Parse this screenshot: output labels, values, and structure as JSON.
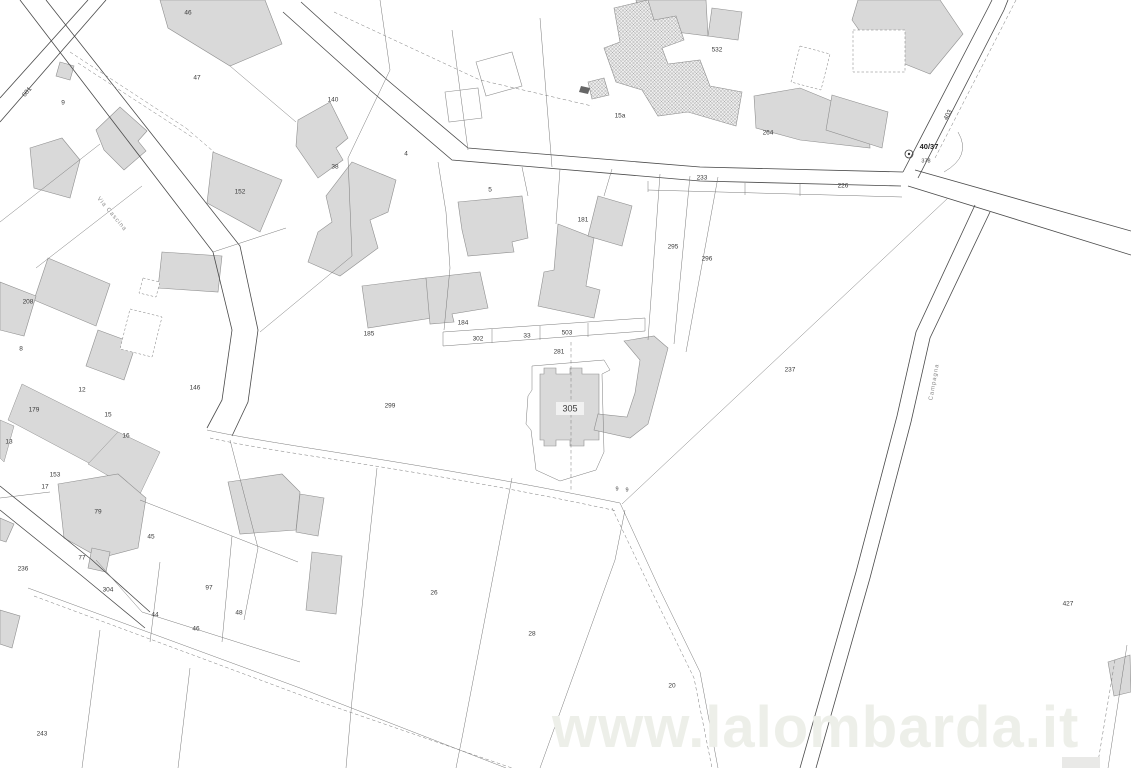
{
  "watermark": {
    "text": "www.lalombarda.it",
    "color": "#edefe9"
  },
  "map": {
    "selected_parcel": "305",
    "colors": {
      "background": "#ffffff",
      "road": "#4a4a4a",
      "boundary": "#7a7a7a",
      "building_fill": "#d9d9d9",
      "building_stroke": "#8f8f8f",
      "hatch_line": "#9a9a9a",
      "hatch_bg": "#ededed",
      "label": "#3a3a3a",
      "street_label": "#8a8a8a",
      "highlight_box": "#f1f1f1"
    },
    "junction_marker": {
      "label": "40/37",
      "sub_label": "378",
      "x": 909,
      "y": 154
    },
    "street_labels": [
      {
        "text": "Via Cascina",
        "x": 112,
        "y": 214,
        "r": 50
      },
      {
        "text": "Campagna",
        "x": 934,
        "y": 382,
        "r": -80
      }
    ],
    "parcel_labels": [
      {
        "t": "46",
        "x": 188,
        "y": 13
      },
      {
        "t": "47",
        "x": 197,
        "y": 78
      },
      {
        "t": "601",
        "x": 27,
        "y": 92,
        "r": -50
      },
      {
        "t": "9",
        "x": 63,
        "y": 103
      },
      {
        "t": "140",
        "x": 333,
        "y": 100
      },
      {
        "t": "38",
        "x": 335,
        "y": 167
      },
      {
        "t": "4",
        "x": 406,
        "y": 154
      },
      {
        "t": "152",
        "x": 240,
        "y": 192
      },
      {
        "t": "532",
        "x": 717,
        "y": 50
      },
      {
        "t": "15a",
        "x": 620,
        "y": 116
      },
      {
        "t": "264",
        "x": 768,
        "y": 133
      },
      {
        "t": "208",
        "x": 28,
        "y": 302
      },
      {
        "t": "8",
        "x": 21,
        "y": 349
      },
      {
        "t": "12",
        "x": 82,
        "y": 390
      },
      {
        "t": "179",
        "x": 34,
        "y": 410
      },
      {
        "t": "15",
        "x": 108,
        "y": 415
      },
      {
        "t": "16",
        "x": 126,
        "y": 436
      },
      {
        "t": "13",
        "x": 9,
        "y": 442
      },
      {
        "t": "146",
        "x": 195,
        "y": 388
      },
      {
        "t": "153",
        "x": 55,
        "y": 475
      },
      {
        "t": "17",
        "x": 45,
        "y": 487
      },
      {
        "t": "236",
        "x": 23,
        "y": 569
      },
      {
        "t": "79",
        "x": 98,
        "y": 512
      },
      {
        "t": "77",
        "x": 82,
        "y": 558
      },
      {
        "t": "304",
        "x": 108,
        "y": 590
      },
      {
        "t": "45",
        "x": 151,
        "y": 537
      },
      {
        "t": "97",
        "x": 209,
        "y": 588
      },
      {
        "t": "44",
        "x": 155,
        "y": 615
      },
      {
        "t": "46",
        "x": 196,
        "y": 629
      },
      {
        "t": "48",
        "x": 239,
        "y": 613
      },
      {
        "t": "243",
        "x": 42,
        "y": 734
      },
      {
        "t": "299",
        "x": 390,
        "y": 406
      },
      {
        "t": "184",
        "x": 463,
        "y": 323
      },
      {
        "t": "185",
        "x": 369,
        "y": 334
      },
      {
        "t": "302",
        "x": 478,
        "y": 339
      },
      {
        "t": "33",
        "x": 527,
        "y": 336
      },
      {
        "t": "503",
        "x": 567,
        "y": 333
      },
      {
        "t": "281",
        "x": 559,
        "y": 352
      },
      {
        "t": "5",
        "x": 490,
        "y": 190
      },
      {
        "t": "181",
        "x": 583,
        "y": 220
      },
      {
        "t": "233",
        "x": 702,
        "y": 178
      },
      {
        "t": "226",
        "x": 843,
        "y": 186
      },
      {
        "t": "295",
        "x": 673,
        "y": 247
      },
      {
        "t": "296",
        "x": 707,
        "y": 259
      },
      {
        "t": "237",
        "x": 790,
        "y": 370
      },
      {
        "t": "305",
        "x": 570,
        "y": 409,
        "s": 9,
        "hl": true
      },
      {
        "t": "9",
        "x": 617,
        "y": 489,
        "s": 5.5
      },
      {
        "t": "9",
        "x": 627,
        "y": 490,
        "s": 5.5
      },
      {
        "t": "26",
        "x": 434,
        "y": 593
      },
      {
        "t": "28",
        "x": 532,
        "y": 634
      },
      {
        "t": "20",
        "x": 672,
        "y": 686
      },
      {
        "t": "427",
        "x": 1068,
        "y": 604
      },
      {
        "t": "403",
        "x": 948,
        "y": 115,
        "r": -62
      }
    ],
    "geometry": {
      "roads": [
        "M20,0 L213,252 L232,330 L222,400 L207,428",
        "M46,0 L240,246 L258,330 L248,402 L232,436",
        "M88,0 L0,98",
        "M106,0 L0,122",
        "M301,2 L385,78 L468,148 L700,167 L903,172",
        "M283,12 L370,90 L452,160 L700,181 L901,186",
        "M903,172 L988,8 L992,0",
        "M918,178 L1004,10 L1008,0",
        "M915,170 L1131,231",
        "M908,186 L1131,255",
        "M975,205 L916,332 L897,416 L856,572 L800,768",
        "M990,212 L930,338 L911,422 L870,578 L816,768",
        "M0,486 L92,560 L150,612",
        "M0,510 L82,576 L145,628"
      ],
      "boundaries": [
        "M948,198 L622,504",
        "M660,174 L648,340",
        "M690,176 L674,344",
        "M718,177 L686,352",
        "M443,332 L645,318",
        "M443,346 L645,331",
        "M443,332 L443,346",
        "M492,329 L492,343",
        "M540,326 L540,340",
        "M588,323 L588,337",
        "M645,318 L645,331",
        "M532,366 L604,360 L610,370 L602,374 L604,452 L596,470 L560,481 L536,470 L531,430 L526,424 L528,396 L532,390 Z",
        "M380,0 L390,70 L348,158",
        "M348,158 L352,256",
        "M352,256 L260,332",
        "M438,162 L446,212 L450,268 L444,330",
        "M522,167 L528,196",
        "M560,169 L556,224",
        "M612,169 L604,196",
        "M648,190 L902,197",
        "M648,181 L648,192",
        "M745,183 L745,195",
        "M800,184 L800,196",
        "M0,222 L100,144",
        "M36,268 L142,186",
        "M230,66 L296,122",
        "M213,252 L286,228",
        "M625,510 L615,560 L540,768",
        "M377,468 L352,700 L346,768",
        "M512,478 L462,738 L456,768",
        "M620,503 L660,590 L700,672 L718,768",
        "M230,440 L258,548 L244,620",
        "M140,500 L232,536 L298,562",
        "M232,536 L222,642",
        "M160,562 L150,642",
        "M96,560 L142,612",
        "M142,612 L300,662",
        "M100,630 L82,768",
        "M190,668 L178,768",
        "M0,498 L50,492",
        "M1127,645 L1108,768",
        "M28,588 L300,688 L506,768",
        "M207,430 C280,446 420,462 620,503",
        "M958,132 Q972,156 944,172",
        "M452,30 L468,150",
        "M540,18 L552,167"
      ],
      "dashed": [
        "M70,52 L186,128",
        "M78,63 L192,137",
        "M186,128 L214,152",
        "M334,12 L480,80 L592,106",
        "M34,596 L306,697 L512,768",
        "M210,438 C280,454 430,470 617,511",
        "M571,342 L571,492",
        "M1016,0 L934,160",
        "M1115,660 L1097,768",
        "M612,508 L654,596 L694,678 L712,768"
      ],
      "buildings": [
        "160,0 265,0 282,44 230,66 168,28",
        "298,120 330,102 348,138 336,148 343,160 318,178 296,146",
        "96,130 120,107 147,131 138,141 146,151 124,170 104,150",
        "30,148 62,138 80,160 70,198 34,188",
        "60,62 74,66 70,80 56,76",
        "213,152 282,180 260,232 207,203",
        "352,162 396,180 388,212 370,220 378,248 340,276 308,262 318,232 332,222 326,196",
        "458,202 522,196 528,238 512,242 514,252 468,256 462,230",
        "362,286 426,278 432,318 368,328",
        "426,278 480,272 488,308 452,314 454,322 430,324",
        "558,224 594,238 586,286 600,290 594,318 538,306 544,272 554,270",
        "598,196 632,206 622,246 588,236",
        "754,96 800,88 868,116 870,148 800,140 756,128",
        "858,0 940,0 963,34 930,74 890,58 866,40 852,20",
        "832,95 888,112 882,148 826,130",
        "636,0 706,0 708,36 660,30 640,22",
        "712,8 742,12 738,40 708,36",
        "540,374 544,374 544,368 556,368 556,374 570,374 570,368 582,368 582,374 599,374 599,440 584,440 584,446 570,446 570,440 556,440 556,446 544,446 544,440 540,440",
        "624,341 654,336 668,348 655,398 648,424 630,438 594,430 598,414 627,417 635,393 640,360",
        "58,484 118,474 146,498 138,548 100,558 64,538",
        "228,482 282,474 300,492 296,530 240,534",
        "300,494 324,498 318,536 296,532",
        "312,552 342,556 336,614 306,610",
        "92,548 110,552 106,572 88,568",
        "48,258 110,284 96,326 34,300",
        "98,330 136,344 124,380 86,366",
        "162,252 222,256 218,292 158,288",
        "0,282 36,296 24,336 0,330",
        "0,610 20,616 12,648 0,644",
        "1108,662 1130,655 1131,692 1114,696",
        "0,518 14,524 6,542 0,540"
      ],
      "gray_areas": [
        "22,384 118,432 102,470 8,420",
        "118,432 160,452 140,494 88,464",
        "0,420 14,426 4,462 0,458"
      ],
      "hatched": [
        "614,8 648,0 654,20 676,16 684,40 662,48 668,64 700,60 710,86 742,92 736,126 688,112 658,116 642,90 616,82 604,48 620,42",
        "588,82 604,78 609,95 592,99"
      ],
      "white_buildings": [
        "476,62 512,52 522,86 486,96",
        "445,92 478,88 482,118 449,122"
      ],
      "dashed_rects": [
        "853,30 905,30 905,72 853,72",
        "143,278 160,282 156,297 139,293",
        "130,309 162,317 152,357 120,349",
        "800,46 830,54 821,90 791,82"
      ],
      "light_rects": [
        {
          "x": 1062,
          "y": 757,
          "w": 38,
          "h": 11
        }
      ],
      "marks": [
        "581,86 590,88 588,94 579,92"
      ]
    }
  }
}
